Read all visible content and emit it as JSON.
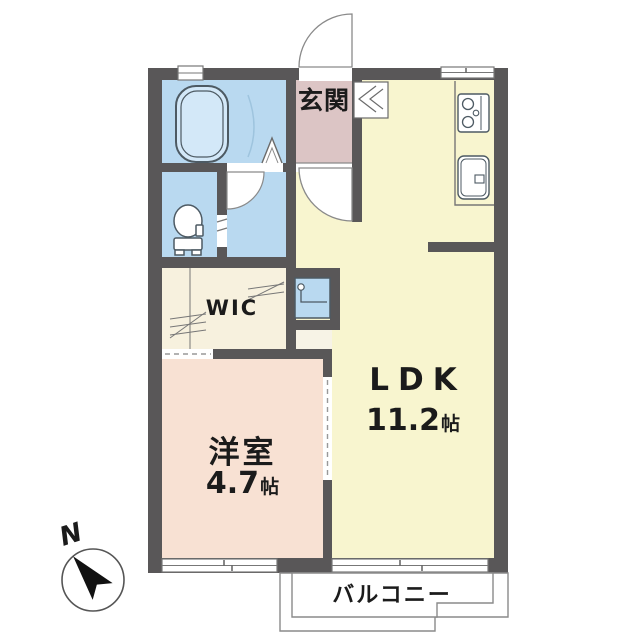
{
  "rooms": {
    "entrance": {
      "label": "玄関",
      "color": "#dcc5c5"
    },
    "ldk": {
      "label": "LDK",
      "size_value": "11.2",
      "size_unit": "帖",
      "color": "#f8f5cf"
    },
    "western": {
      "label": "洋室",
      "size_value": "4.7",
      "size_unit": "帖",
      "color": "#f8e1d3"
    },
    "wic": {
      "label": "WIC",
      "color": "#f7f1de"
    },
    "balcony": {
      "label": "バルコニー"
    },
    "bathroom": {
      "color": "#b9d9f0"
    },
    "toilet": {
      "color": "#b9d9f0"
    },
    "washroom": {
      "color": "#b9d9f0"
    },
    "laundry": {
      "color": "#b9d9f0"
    },
    "hall_pocket": {
      "color": "#f7f3e6"
    }
  },
  "compass": {
    "label": "N"
  },
  "colors": {
    "wall": "#595758",
    "fixture_outline": "#4d5a63",
    "thin_line": "#8a8a8a"
  }
}
